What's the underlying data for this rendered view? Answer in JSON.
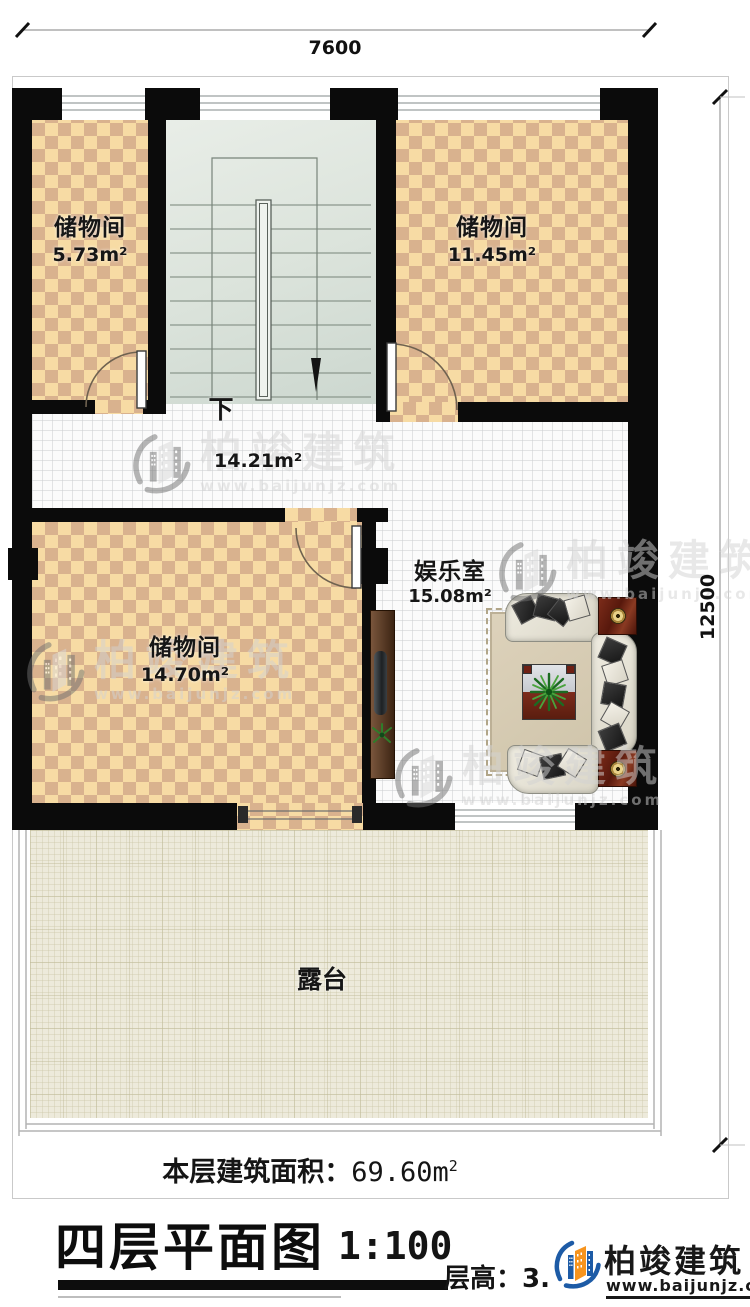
{
  "dimensions": {
    "top": "7600",
    "right": "12500"
  },
  "rooms": {
    "storage_top_left": {
      "name": "储物间",
      "area": "5.73m²"
    },
    "storage_top_right": {
      "name": "储物间",
      "area": "11.45m²"
    },
    "storage_bottom_left": {
      "name": "储物间",
      "area": "14.70m²"
    },
    "entertainment": {
      "name": "娱乐室",
      "area": "15.08m²"
    },
    "hallway": {
      "area": "14.21m²"
    },
    "terrace": {
      "name": "露台"
    },
    "stairs": {
      "direction_label": "下"
    }
  },
  "footer": {
    "floor_area_label": "本层建筑面积：",
    "floor_area_value": "69.60m",
    "floor_area_sup": "2",
    "plan_title": "四层平面图",
    "scale": "1:100",
    "floor_height": "层高：3."
  },
  "branding": {
    "company": "柏竣建筑",
    "website": "www.baijunjz.com"
  },
  "watermark": {
    "company": "柏竣建筑",
    "website": "www.baijunjz.com"
  },
  "colors": {
    "wall": "#0b0b0b",
    "checker_light": "#f7dba4",
    "checker_dark": "#d9b28e",
    "stair_floor": "#dde5dd",
    "terrace_floor": "#edeadb",
    "logo_blue": "#1d5ba6",
    "logo_orange": "#f7941d"
  }
}
